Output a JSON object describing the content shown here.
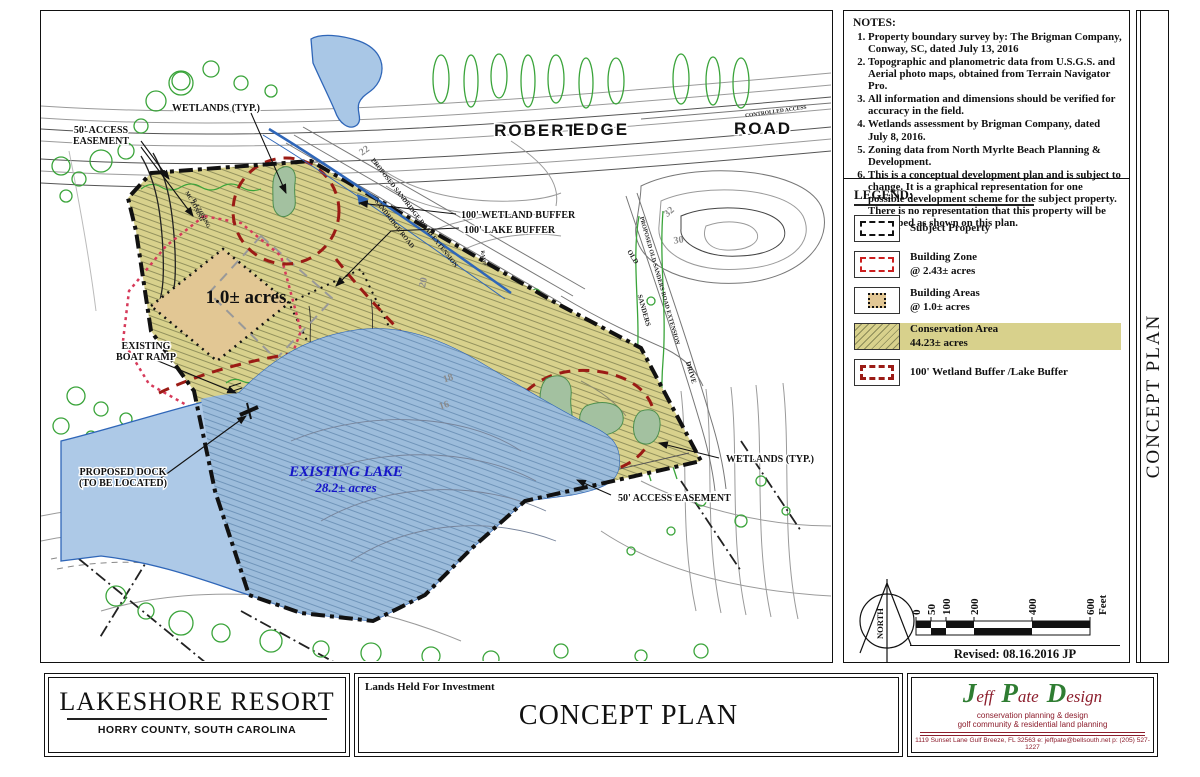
{
  "sheet": {
    "side_title": "CONCEPT PLAN"
  },
  "notes": {
    "title": "NOTES:",
    "items": [
      "Property boundary survey by: The Brigman Company, Conway, SC, dated July 13, 2016",
      "Topographic and planometric data from U.S.G.S. and Aerial photo maps, obtained from Terrain Navigator Pro.",
      "All information and dimensions should be verified for accuracy in the field.",
      "Wetlands assessment by Brigman Company, dated July 8, 2016.",
      "Zoning data from North Myrlte Beach Planning & Development.",
      "This is a conceptual development plan and is subject to change. It is a graphical representation for one possible development scheme for the subject property.  There is no representation that this property will be developed as shown on this plan."
    ]
  },
  "legend": {
    "title": "LEGEND:",
    "items": [
      {
        "key": "sw-subject",
        "name": "subject-property",
        "label": "Subject Property",
        "sublabel": ""
      },
      {
        "key": "sw-zone",
        "name": "building-zone",
        "label": "Building Zone",
        "sublabel": "@ 2.43± acres"
      },
      {
        "key": "sw-bareas",
        "name": "building-areas",
        "label": "Building Areas",
        "sublabel": "@ 1.0± acres"
      },
      {
        "key": "sw-cons",
        "name": "conservation-area",
        "label": "Conservation Area",
        "sublabel": "44.23± acres"
      },
      {
        "key": "sw-buffer",
        "name": "wetland-lake-buffer",
        "label": "100' Wetland Buffer /Lake Buffer",
        "sublabel": ""
      }
    ]
  },
  "compass": {
    "label": "NORTH"
  },
  "scale_bar": {
    "unit": "Feet",
    "ticks": [
      {
        "label": "0",
        "x": 0
      },
      {
        "label": "50",
        "x": 15
      },
      {
        "label": "100",
        "x": 30
      },
      {
        "label": "200",
        "x": 58
      },
      {
        "label": "400",
        "x": 116
      },
      {
        "label": "600",
        "x": 174
      }
    ]
  },
  "revision": "Revised: 08.16.2016 JP",
  "title_block": {
    "project_name": "LAKESHORE RESORT",
    "project_location": "HORRY COUNTY, SOUTH CAROLINA",
    "ownership_note": "Lands Held For Investment",
    "sheet_title": "CONCEPT PLAN",
    "firm": {
      "name_parts": [
        {
          "cap": "J",
          "rest": "eff"
        },
        {
          "cap": "P",
          "rest": "ate"
        },
        {
          "cap": "D",
          "rest": "esign"
        }
      ],
      "tagline1": "conservation planning & design",
      "tagline2": "golf community & residential land planning",
      "address": "1119 Sunset Lane  Gulf Breeze, FL 32563   e: jeffpate@bellsouth.net   p: (205) 527-1227"
    }
  },
  "map": {
    "labels": [
      {
        "id": "wetlands-typ-left",
        "text": "WETLANDS (TYP.)",
        "x": 175,
        "y": 100,
        "size": 10,
        "anchor": "middle",
        "cls": "lbl"
      },
      {
        "id": "access-easement-left-1",
        "text": "50' ACCESS",
        "x": 60,
        "y": 122,
        "size": 10,
        "anchor": "middle",
        "cls": "lbl"
      },
      {
        "id": "access-easement-left-2",
        "text": "EASEMENT",
        "x": 60,
        "y": 133,
        "size": 10,
        "anchor": "middle",
        "cls": "lbl"
      },
      {
        "id": "wetland-buffer-label",
        "text": "100' WETLAND BUFFER",
        "x": 420,
        "y": 207,
        "size": 10,
        "anchor": "start",
        "cls": "lbl"
      },
      {
        "id": "lake-buffer-label",
        "text": "100' LAKE BUFFER",
        "x": 423,
        "y": 222,
        "size": 10,
        "anchor": "start",
        "cls": "lbl"
      },
      {
        "id": "building-area-acreage",
        "text": "1.0± acres",
        "x": 205,
        "y": 292,
        "size": 19,
        "anchor": "middle",
        "cls": "lbl-plain"
      },
      {
        "id": "boat-ramp-1",
        "text": "EXISTING",
        "x": 105,
        "y": 338,
        "size": 10,
        "anchor": "middle",
        "cls": "lbl"
      },
      {
        "id": "boat-ramp-2",
        "text": "BOAT RAMP",
        "x": 105,
        "y": 349,
        "size": 10,
        "anchor": "middle",
        "cls": "lbl"
      },
      {
        "id": "dock-1",
        "text": "PROPOSED DOCK",
        "x": 82,
        "y": 464,
        "size": 10,
        "anchor": "middle",
        "cls": "lbl"
      },
      {
        "id": "dock-2",
        "text": "(TO BE LOCATED)",
        "x": 82,
        "y": 475,
        "size": 10,
        "anchor": "middle",
        "cls": "lbl"
      },
      {
        "id": "lake-name",
        "text": "EXISTING LAKE",
        "x": 305,
        "y": 465,
        "size": 15,
        "anchor": "middle",
        "cls": "lbl-blue"
      },
      {
        "id": "lake-acreage",
        "text": "28.2± acres",
        "x": 305,
        "y": 481,
        "size": 13,
        "anchor": "middle",
        "cls": "lbl-blue"
      },
      {
        "id": "wetlands-typ-right",
        "text": "WETLANDS (TYP.)",
        "x": 685,
        "y": 451,
        "size": 10,
        "anchor": "start",
        "cls": "lbl"
      },
      {
        "id": "access-easement-right",
        "text": "50' ACCESS EASEMENT",
        "x": 577,
        "y": 490,
        "size": 10,
        "anchor": "start",
        "cls": "lbl"
      },
      {
        "id": "road-robert",
        "text": "ROBERT",
        "x": 495,
        "y": 125,
        "size": 17,
        "anchor": "middle",
        "cls": "lbl-sans"
      },
      {
        "id": "road-edge",
        "text": "EDGE",
        "x": 560,
        "y": 124,
        "size": 17,
        "anchor": "middle",
        "cls": "lbl-sans"
      },
      {
        "id": "road-road",
        "text": "ROAD",
        "x": 722,
        "y": 123,
        "size": 17,
        "anchor": "middle",
        "cls": "lbl-sans"
      },
      {
        "id": "controlled-access",
        "text": "CONTROLLED ACCESS",
        "x": 735,
        "y": 102,
        "size": 5.5,
        "anchor": "middle",
        "rot": -8,
        "cls": "lbl-road"
      },
      {
        "id": "sandridge-ext",
        "text": "PROPOSED SANDRIDGE ROAD EXTENSION",
        "x": 372,
        "y": 203,
        "size": 6.5,
        "anchor": "middle",
        "rot": 52,
        "cls": "lbl-road"
      },
      {
        "id": "sandridge",
        "text": "SANDRIDGE ROAD",
        "x": 352,
        "y": 214,
        "size": 6.5,
        "anchor": "middle",
        "rot": 52,
        "cls": "lbl-road"
      },
      {
        "id": "old-sanders-ext",
        "text": "PROPOSED OLD SANDERS ROAD EXTENSION",
        "x": 617,
        "y": 270,
        "size": 6,
        "anchor": "middle",
        "rot": 74,
        "cls": "lbl-road"
      },
      {
        "id": "old",
        "text": "OLD",
        "x": 590,
        "y": 247,
        "size": 7,
        "anchor": "middle",
        "rot": 58,
        "cls": "lbl-road"
      },
      {
        "id": "sanders",
        "text": "SANDERS",
        "x": 601,
        "y": 300,
        "size": 7,
        "anchor": "middle",
        "rot": 74,
        "cls": "lbl-road"
      },
      {
        "id": "drive",
        "text": "DRIVE",
        "x": 648,
        "y": 362,
        "size": 7,
        "anchor": "middle",
        "rot": 74,
        "cls": "lbl-road"
      },
      {
        "id": "ramp",
        "text": "RAMP",
        "x": 441,
        "y": 247,
        "size": 5,
        "anchor": "middle",
        "rot": 82,
        "cls": "lbl-road"
      },
      {
        "id": "contour-22",
        "text": "22",
        "x": 325,
        "y": 142,
        "size": 10,
        "anchor": "middle",
        "rot": -35,
        "cls": "lbl-gray"
      },
      {
        "id": "contour-20",
        "text": "20",
        "x": 385,
        "y": 272,
        "size": 10,
        "anchor": "middle",
        "rot": -78,
        "cls": "lbl-gray"
      },
      {
        "id": "contour-30",
        "text": "30",
        "x": 638,
        "y": 232,
        "size": 10,
        "anchor": "middle",
        "rot": -8,
        "cls": "lbl-gray"
      },
      {
        "id": "contour-32",
        "text": "32",
        "x": 630,
        "y": 203,
        "size": 10,
        "anchor": "middle",
        "rot": -42,
        "cls": "lbl-gray"
      },
      {
        "id": "contour-18",
        "text": "18",
        "x": 408,
        "y": 370,
        "size": 10,
        "anchor": "middle",
        "rot": -18,
        "cls": "lbl-gray"
      },
      {
        "id": "contour-16",
        "text": "16",
        "x": 404,
        "y": 397,
        "size": 10,
        "anchor": "middle",
        "rot": -18,
        "cls": "lbl-gray"
      },
      {
        "id": "zoning-mc",
        "text": "MC ZONING",
        "x": 152,
        "y": 196,
        "size": 5.5,
        "anchor": "middle",
        "rot": 62,
        "cls": "lbl-road"
      },
      {
        "id": "zoning-r4",
        "text": "R-4 ZONING",
        "x": 159,
        "y": 203,
        "size": 5.5,
        "anchor": "middle",
        "rot": 62,
        "cls": "lbl-road"
      }
    ]
  },
  "colors": {
    "conservation": "#d8d18c",
    "conservation_hatch": "#8a8a58",
    "lake_inside": "#9cbcdb",
    "lake_outside": "#adc9e7",
    "water_line": "#2f66b8",
    "buffer_red": "#9b1b15",
    "building_zone_pink": "#d63a5a",
    "building_tan": "#e2c794",
    "tree_green": "#3aa43a",
    "wetland_green": "#a3c1a0",
    "logo_green": "#2f7d32",
    "logo_maroon": "#8c1d2c"
  }
}
